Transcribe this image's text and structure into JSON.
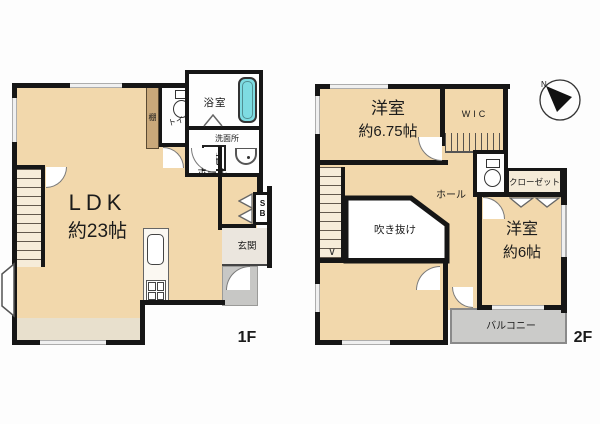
{
  "floor1": {
    "floor_label": "1F",
    "ldk_name": "LDK",
    "ldk_size": "約23帖",
    "toilet_label": "トイレ",
    "shelf_label": "棚",
    "bath_label": "浴室",
    "washroom_label": "洗面所",
    "washer_label": "洗",
    "hall_label": "ホール",
    "shoebox_top": "S",
    "shoebox_bottom": "B",
    "entrance_label": "玄関"
  },
  "floor2": {
    "floor_label": "2F",
    "bedroom1_name": "洋室",
    "bedroom1_size": "約6.75帖",
    "wic_label": "WIC",
    "hall_label": "ホール",
    "void_label": "吹き抜け",
    "closet_label": "クローゼット",
    "bedroom2_name": "洋室",
    "bedroom2_size": "約6帖",
    "balcony_label": "バルコニー",
    "stairs_down_arrow": "∨",
    "compass_north_label": "N"
  },
  "colors": {
    "floor_beige": "#F2D8AC",
    "wall_black": "#161616",
    "shelf_tan": "#C9A87A",
    "bathtub_cyan": "#7EDCE2",
    "entrance_gray": "#EBE6DE",
    "porch_gray": "#C7C7C5",
    "balcony_gray": "#CBCBC9",
    "deck_strip": "#E8E0CD",
    "background": "#FFFFFF"
  },
  "icons": {
    "compass": "north-arrow-icon",
    "toilet_first_floor": "toilet-icon",
    "toilet_second_floor": "toilet-icon",
    "bathtub": "bathtub-icon",
    "washbasin": "washbasin-icon",
    "kitchen_sink": "kitchen-sink-icon",
    "stove": "stove-icon",
    "stairs": "stairs-icon",
    "wic_rail": "clothes-hanger-icon",
    "bay_window": "bay-window-icon"
  }
}
